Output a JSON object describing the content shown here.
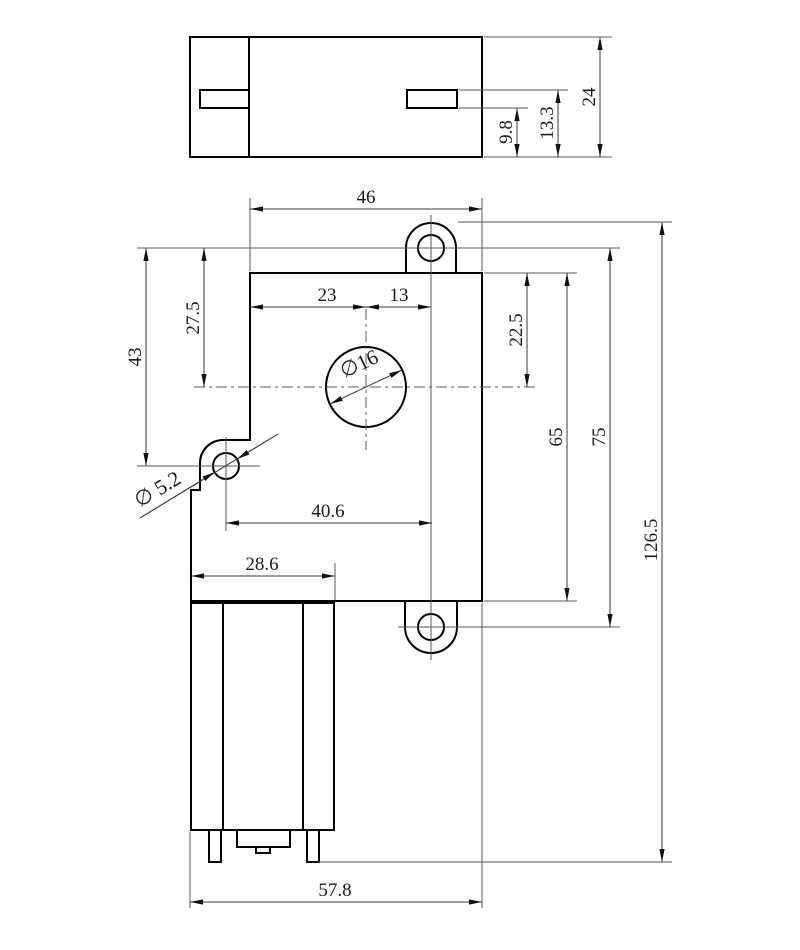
{
  "drawing": {
    "top_view": {
      "dim_height": "24",
      "dim_slot_top_to_base": "13.3",
      "dim_slot_bottom_to_base": "9.8"
    },
    "front_view": {
      "dim_body_width": "46",
      "dim_center_from_left": "23",
      "dim_center_to_ear_axis": "13",
      "dim_ear_to_center_vertical": "27.5",
      "dim_ear_to_side_hole": "43",
      "dim_top_to_center": "22.5",
      "dim_body_height": "65",
      "dim_ear_centers_span": "75",
      "dim_overall_height": "126.5",
      "dim_side_hole_to_ear_axis": "40.6",
      "dim_motor_width": "28.6",
      "dim_overall_width": "57.8",
      "label_bore_diameter": "∅16",
      "label_side_hole_diameter": "∅ 5.2"
    }
  }
}
